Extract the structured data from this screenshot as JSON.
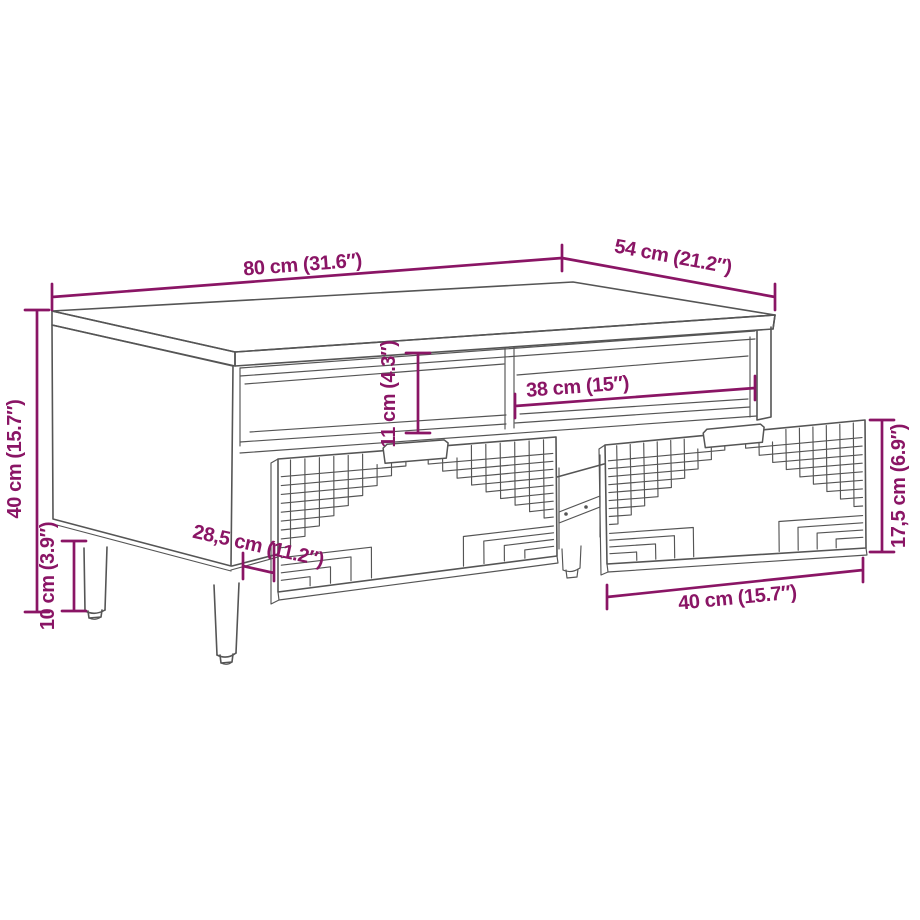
{
  "page": {
    "description": "Dimension diagram of a coffee table with open shelf compartments, two pulled-out drawers with geometric fret-pattern fronts and round tapered legs"
  },
  "palette": {
    "dimension_color": "#8A1565",
    "line_art_color": "#555555",
    "background": "#FFFFFF"
  },
  "dimensions": [
    {
      "id": "top-width",
      "label": "80 cm (31.6″)"
    },
    {
      "id": "top-depth",
      "label": "54 cm (21.2″)"
    },
    {
      "id": "overall-height",
      "label": "40 cm (15.7″)"
    },
    {
      "id": "leg-height",
      "label": "10 cm (3.9″)"
    },
    {
      "id": "shelf-opening-height",
      "label": "11 cm (4.3″)"
    },
    {
      "id": "shelf-opening-width",
      "label": "38 cm (15″)"
    },
    {
      "id": "drawer-depth",
      "label": "28,5 cm (11.2″)"
    },
    {
      "id": "drawer-front-height",
      "label": "17,5 cm (6.9″)"
    },
    {
      "id": "drawer-width",
      "label": "40 cm (15.7″)"
    }
  ]
}
